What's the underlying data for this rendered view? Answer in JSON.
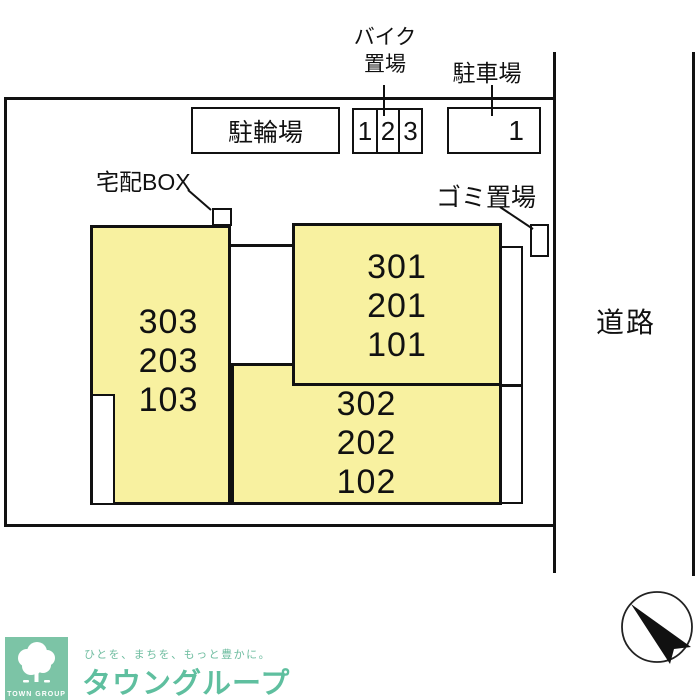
{
  "plan": {
    "road_label": "道路",
    "bicycle_parking_label": "駐輪場",
    "bike_parking_label_line1": "バイク",
    "bike_parking_label_line2": "置場",
    "car_parking_label": "駐車場",
    "delivery_box_label": "宅配BOX",
    "garbage_label": "ゴミ置場",
    "bike_spaces": [
      "1",
      "2",
      "3"
    ],
    "car_spaces": [
      "1"
    ],
    "units": {
      "left": [
        "303",
        "203",
        "103"
      ],
      "right": [
        "301",
        "201",
        "101"
      ],
      "bottom": [
        "302",
        "202",
        "102"
      ]
    },
    "colors": {
      "building_fill": "#F8F1A0",
      "line": "#111111"
    }
  },
  "footer": {
    "logo_text": "TOWN GROUP",
    "tagline": "ひとを、まちを、もっと豊かに。",
    "brand": "タウングループ",
    "logo_green": "#7CC4A6",
    "brand_green": "#5FBF9F"
  }
}
